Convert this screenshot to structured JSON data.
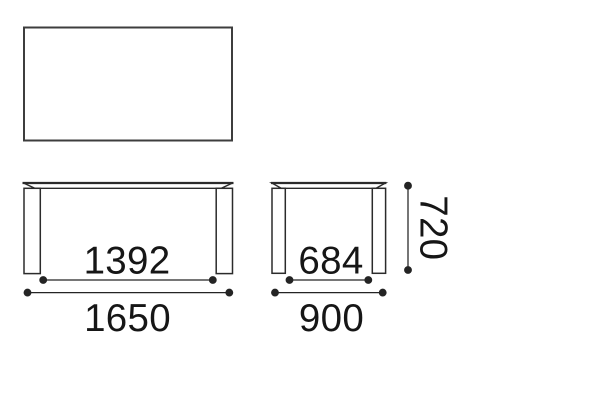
{
  "diagram": {
    "background_color": "#ffffff",
    "outline_color": "#3d3d3d",
    "drawing_line_color": "#2b2b2b",
    "dimension_line_color": "#242424",
    "text_color": "#161616",
    "dimensions": {
      "front_inner_width": "1392",
      "front_total_width": "1650",
      "side_inner_depth": "684",
      "side_total_depth": "900",
      "height": "720"
    }
  }
}
